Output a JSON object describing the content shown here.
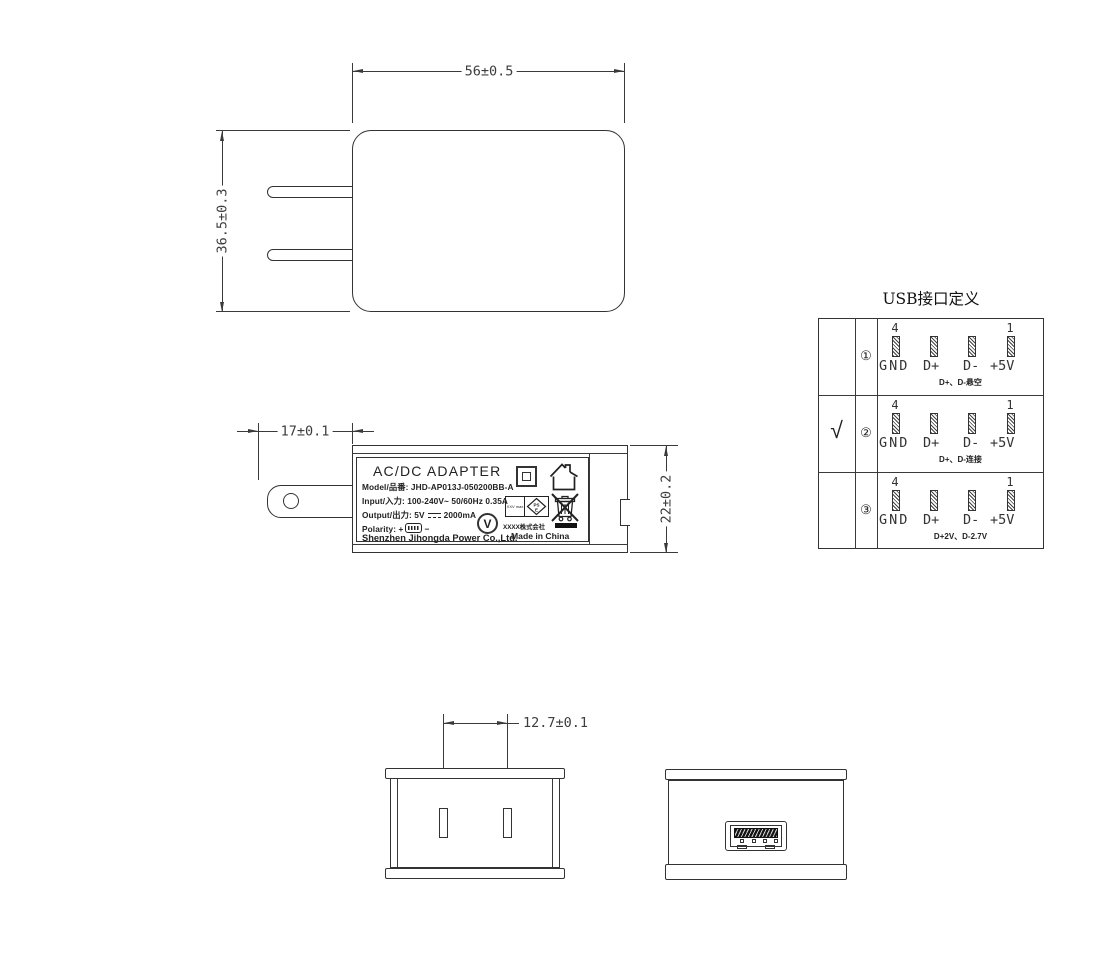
{
  "front_view": {
    "width_dim": "56±0.5",
    "height_dim": "36.5±0.3"
  },
  "side_view": {
    "prong_dim": "17±0.1",
    "depth_dim": "22±0.2",
    "label": {
      "title": "AC/DC  ADAPTER",
      "model": "Model/品番: JHD-AP013J-050200BB-A",
      "input": "Input/入力: 100-240V~  50/60Hz  0.35A",
      "output_prefix": "Output/出力: 5V",
      "output_suffix": "2000mA",
      "polarity_label": "Polarity:",
      "polarity_plus": "+",
      "polarity_minus": "−",
      "company": "Shenzhen Jihongda Power Co.,Ltd.",
      "efficiency_mark": "V",
      "pse_left_text": "XXV max",
      "pse_line1": "PS",
      "pse_line2": "E",
      "maker": "XXXX株式会社",
      "origin": "Made in China"
    }
  },
  "bottom_views": {
    "pin_pitch_dim": "12.7±0.1"
  },
  "usb_table": {
    "title": "USB接口定义",
    "pin_number_left": "4",
    "pin_number_right": "1",
    "pin_labels": [
      "GND",
      "D+",
      "D-",
      "+5V"
    ],
    "rows": [
      {
        "check": "",
        "index": "①",
        "note": "D+、D-悬空"
      },
      {
        "check": "√",
        "index": "②",
        "note": "D+、D-连接"
      },
      {
        "check": "",
        "index": "③",
        "note": "D+2V、D-2.7V"
      }
    ]
  }
}
